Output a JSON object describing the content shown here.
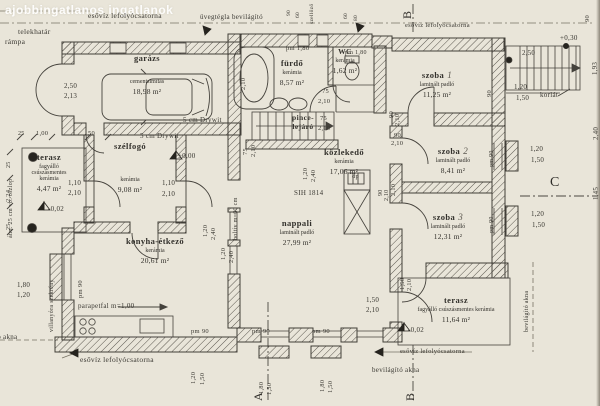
{
  "watermark": "ajobbingatlanos ingatlanok",
  "rooms": [
    {
      "name": "garázs",
      "num": "",
      "finish": "cementsimítás",
      "area": "18,98 m²"
    },
    {
      "name": "fürdő",
      "num": "",
      "finish": "kerámia",
      "area": "8,57 m²"
    },
    {
      "name": "WC",
      "num": "",
      "finish": "kerámia",
      "area": "1,62 m²"
    },
    {
      "name": "pince-lejáró",
      "num": "",
      "finish": "",
      "area": ""
    },
    {
      "name": "közlekedő",
      "num": "",
      "finish": "kerámia",
      "area": "17,06 m²"
    },
    {
      "name": "szoba",
      "num": "1",
      "finish": "laminált padló",
      "area": "11,25 m²"
    },
    {
      "name": "szoba",
      "num": "2",
      "finish": "laminált padló",
      "area": "8,41 m²"
    },
    {
      "name": "szoba",
      "num": "3",
      "finish": "laminált padló",
      "area": "12,31 m²"
    },
    {
      "name": "nappali",
      "num": "",
      "finish": "laminált padló",
      "area": "27,99 m²"
    },
    {
      "name": "konyha-étkező",
      "num": "",
      "finish": "kerámia",
      "area": "20,61 m²"
    },
    {
      "name": "szélfogó",
      "num": "",
      "finish": "kerámia",
      "area": "9,08 m²"
    },
    {
      "name": "terasz",
      "num": "",
      "finish": "fagyálló csúszásmentes kerámia",
      "area": "4,47 m²"
    },
    {
      "name": "terasz",
      "num": "",
      "finish": "fagyálló csúszásmentes kerámia",
      "area": "11,64 m²"
    }
  ],
  "annotations": [
    {
      "t": "esővíz lefolyócsatorna",
      "x": 88,
      "y": 12
    },
    {
      "t": "üvegtégla bevilágító",
      "x": 200,
      "y": 14,
      "s": 7
    },
    {
      "t": "telekhatár",
      "x": 18,
      "y": 28
    },
    {
      "t": "rámpa",
      "x": 5,
      "y": 38
    },
    {
      "t": "esővíz lefolyócsatorna",
      "x": 405,
      "y": 23,
      "s": 6.5
    },
    {
      "t": "+0,30",
      "x": 560,
      "y": 35,
      "s": 7
    },
    {
      "t": "korlát",
      "x": 540,
      "y": 92,
      "s": 7
    },
    {
      "t": "szellőző",
      "x": 310,
      "y": 24,
      "r": 1,
      "s": 5.5
    },
    {
      "t": "pm 1,80",
      "x": 286,
      "y": 46,
      "s": 6.5
    },
    {
      "t": "pm 1,80",
      "x": 345,
      "y": 50,
      "s": 6
    },
    {
      "t": "SIH 1814",
      "x": 294,
      "y": 190,
      "s": 7
    },
    {
      "t": "dp",
      "x": 352,
      "y": 174,
      "s": 6.5
    },
    {
      "t": "boltív m=60 cm",
      "x": 233,
      "y": 240,
      "r": 1,
      "s": 6
    },
    {
      "t": "5 cm Drywit",
      "x": 183,
      "y": 117,
      "s": 7
    },
    {
      "t": "5 cm Drywit",
      "x": 140,
      "y": 133,
      "s": 7
    },
    {
      "t": "átm. 25 cm vb. oszlop",
      "x": 8,
      "y": 238,
      "r": 1,
      "s": 6
    },
    {
      "t": "villanyóra szekrény",
      "x": 49,
      "y": 332,
      "r": 1,
      "s": 6
    },
    {
      "t": "parapetfal m=1,00",
      "x": 78,
      "y": 303,
      "s": 7
    },
    {
      "t": "esővíz lefolyócsatorna",
      "x": 80,
      "y": 356
    },
    {
      "t": "esővíz lefolyócsatorna",
      "x": 400,
      "y": 349,
      "s": 6.5
    },
    {
      "t": "bevilágító akna",
      "x": 372,
      "y": 367,
      "s": 7
    },
    {
      "t": "bevilágító akna",
      "x": 524,
      "y": 332,
      "r": 1,
      "s": 6
    },
    {
      "t": "bevilágító akna",
      "x": -30,
      "y": 334,
      "s": 7
    },
    {
      "t": "±0,00",
      "x": 178,
      "y": 153,
      "s": 7
    },
    {
      "t": "-0,02",
      "x": 48,
      "y": 206,
      "s": 7
    },
    {
      "t": "-0,02",
      "x": 408,
      "y": 327,
      "s": 7
    },
    {
      "t": "pm 90",
      "x": 191,
      "y": 329,
      "s": 6.5
    },
    {
      "t": "pm 90",
      "x": 252,
      "y": 329,
      "s": 6.5
    },
    {
      "t": "pm 90",
      "x": 312,
      "y": 329,
      "s": 6.5
    },
    {
      "t": "pm 90",
      "x": 78,
      "y": 298,
      "r": 1,
      "s": 6.5
    },
    {
      "t": "pm 90",
      "x": 489,
      "y": 167,
      "r": 1,
      "s": 6
    },
    {
      "t": "pm 90",
      "x": 489,
      "y": 233,
      "r": 1,
      "s": 6
    },
    {
      "t": "A",
      "x": 252,
      "y": 401,
      "r": 1,
      "s": 12,
      "cls": "sec"
    },
    {
      "t": "B",
      "x": 404,
      "y": 401,
      "r": 1,
      "s": 12,
      "cls": "sec"
    },
    {
      "t": "B",
      "x": 401,
      "y": 19,
      "r": 1,
      "s": 12,
      "cls": "sec"
    },
    {
      "t": "C",
      "x": 550,
      "y": 176,
      "s": 14,
      "cls": "sec"
    }
  ],
  "dimensions": [
    {
      "t": "2,50",
      "x": 64,
      "y": 83
    },
    {
      "t": "2,13",
      "x": 64,
      "y": 93
    },
    {
      "t": "25",
      "x": 18,
      "y": 131,
      "s": 6
    },
    {
      "t": "1,00",
      "x": 36,
      "y": 131,
      "s": 6.5
    },
    {
      "t": "50",
      "x": 88,
      "y": 131,
      "s": 6.5
    },
    {
      "t": "25",
      "x": 6,
      "y": 168,
      "r": 1,
      "s": 6
    },
    {
      "t": "2,24",
      "x": 6,
      "y": 202,
      "r": 1,
      "s": 6.5
    },
    {
      "t": "25",
      "x": 6,
      "y": 230,
      "r": 1,
      "s": 6
    },
    {
      "t": "1,80",
      "x": 17,
      "y": 282
    },
    {
      "t": "1,20",
      "x": 17,
      "y": 292
    },
    {
      "t": "1,10",
      "x": 68,
      "y": 180
    },
    {
      "t": "2,10",
      "x": 68,
      "y": 190
    },
    {
      "t": "1,10",
      "x": 162,
      "y": 180
    },
    {
      "t": "2,10",
      "x": 162,
      "y": 191
    },
    {
      "t": "90",
      "x": 287,
      "y": 16,
      "r": 1,
      "s": 5.5
    },
    {
      "t": "60",
      "x": 296,
      "y": 18,
      "r": 1,
      "s": 5.5
    },
    {
      "t": "60",
      "x": 344,
      "y": 19,
      "r": 1,
      "s": 5.5
    },
    {
      "t": "80",
      "x": 354,
      "y": 21,
      "r": 1,
      "s": 5.5
    },
    {
      "t": "75",
      "x": 322,
      "y": 89,
      "s": 6.5
    },
    {
      "t": "2,10",
      "x": 318,
      "y": 99,
      "s": 6.5
    },
    {
      "t": "2,10",
      "x": 241,
      "y": 90,
      "r": 1,
      "s": 6.5
    },
    {
      "t": "75",
      "x": 320,
      "y": 116,
      "s": 6.5
    },
    {
      "t": "2,10",
      "x": 318,
      "y": 126,
      "s": 6.5
    },
    {
      "t": "75",
      "x": 243,
      "y": 155,
      "r": 1,
      "s": 6.5
    },
    {
      "t": "2,10",
      "x": 251,
      "y": 157,
      "r": 1,
      "s": 6.5
    },
    {
      "t": "1,20",
      "x": 203,
      "y": 237,
      "r": 1,
      "s": 6.5
    },
    {
      "t": "2,40",
      "x": 211,
      "y": 240,
      "r": 1,
      "s": 6.5
    },
    {
      "t": "1,20",
      "x": 221,
      "y": 260,
      "r": 1,
      "s": 6.5
    },
    {
      "t": "2,40",
      "x": 229,
      "y": 263,
      "r": 1,
      "s": 6.5
    },
    {
      "t": "1,20",
      "x": 303,
      "y": 180,
      "r": 1,
      "s": 6.5
    },
    {
      "t": "2,40",
      "x": 311,
      "y": 182,
      "r": 1,
      "s": 6.5
    },
    {
      "t": "90",
      "x": 394,
      "y": 133,
      "s": 6.5
    },
    {
      "t": "2,10",
      "x": 391,
      "y": 141,
      "s": 6.5
    },
    {
      "t": "90",
      "x": 389,
      "y": 118,
      "r": 1,
      "s": 6.5
    },
    {
      "t": "2,10",
      "x": 395,
      "y": 126,
      "r": 1,
      "s": 6.5
    },
    {
      "t": "90",
      "x": 487,
      "y": 97,
      "r": 1,
      "s": 6.5
    },
    {
      "t": "2,10",
      "x": 391,
      "y": 196,
      "r": 1,
      "s": 6.5
    },
    {
      "t": "90",
      "x": 378,
      "y": 196,
      "r": 1,
      "s": 6
    },
    {
      "t": "2,10",
      "x": 384,
      "y": 201,
      "r": 1,
      "s": 6
    },
    {
      "t": "1,20",
      "x": 530,
      "y": 146
    },
    {
      "t": "1,50",
      "x": 531,
      "y": 157
    },
    {
      "t": "1,20",
      "x": 531,
      "y": 211
    },
    {
      "t": "1,50",
      "x": 532,
      "y": 222
    },
    {
      "t": "1,20",
      "x": 514,
      "y": 84
    },
    {
      "t": "1,50",
      "x": 516,
      "y": 95
    },
    {
      "t": "2,50",
      "x": 522,
      "y": 50
    },
    {
      "t": "1,93",
      "x": 592,
      "y": 75,
      "r": 1
    },
    {
      "t": "2,40",
      "x": 593,
      "y": 140,
      "r": 1
    },
    {
      "t": "1,45",
      "x": 593,
      "y": 200,
      "r": 1
    },
    {
      "t": "1,50",
      "x": 366,
      "y": 297
    },
    {
      "t": "2,10",
      "x": 366,
      "y": 307
    },
    {
      "t": "1,50",
      "x": 400,
      "y": 290,
      "r": 1,
      "s": 6.5
    },
    {
      "t": "2,10",
      "x": 407,
      "y": 291,
      "r": 1,
      "s": 6.5
    },
    {
      "t": "1,20",
      "x": 191,
      "y": 384,
      "r": 1,
      "s": 6.5
    },
    {
      "t": "1,50",
      "x": 200,
      "y": 385,
      "r": 1,
      "s": 6.5
    },
    {
      "t": "1,80",
      "x": 259,
      "y": 394,
      "r": 1,
      "s": 6.5
    },
    {
      "t": "1,50",
      "x": 267,
      "y": 395,
      "r": 1,
      "s": 6.5
    },
    {
      "t": "1,80",
      "x": 320,
      "y": 392,
      "r": 1,
      "s": 6.5
    },
    {
      "t": "1,50",
      "x": 328,
      "y": 393,
      "r": 1,
      "s": 6.5
    },
    {
      "t": "90",
      "x": 585,
      "y": 22,
      "r": 1,
      "s": 6.5
    }
  ]
}
